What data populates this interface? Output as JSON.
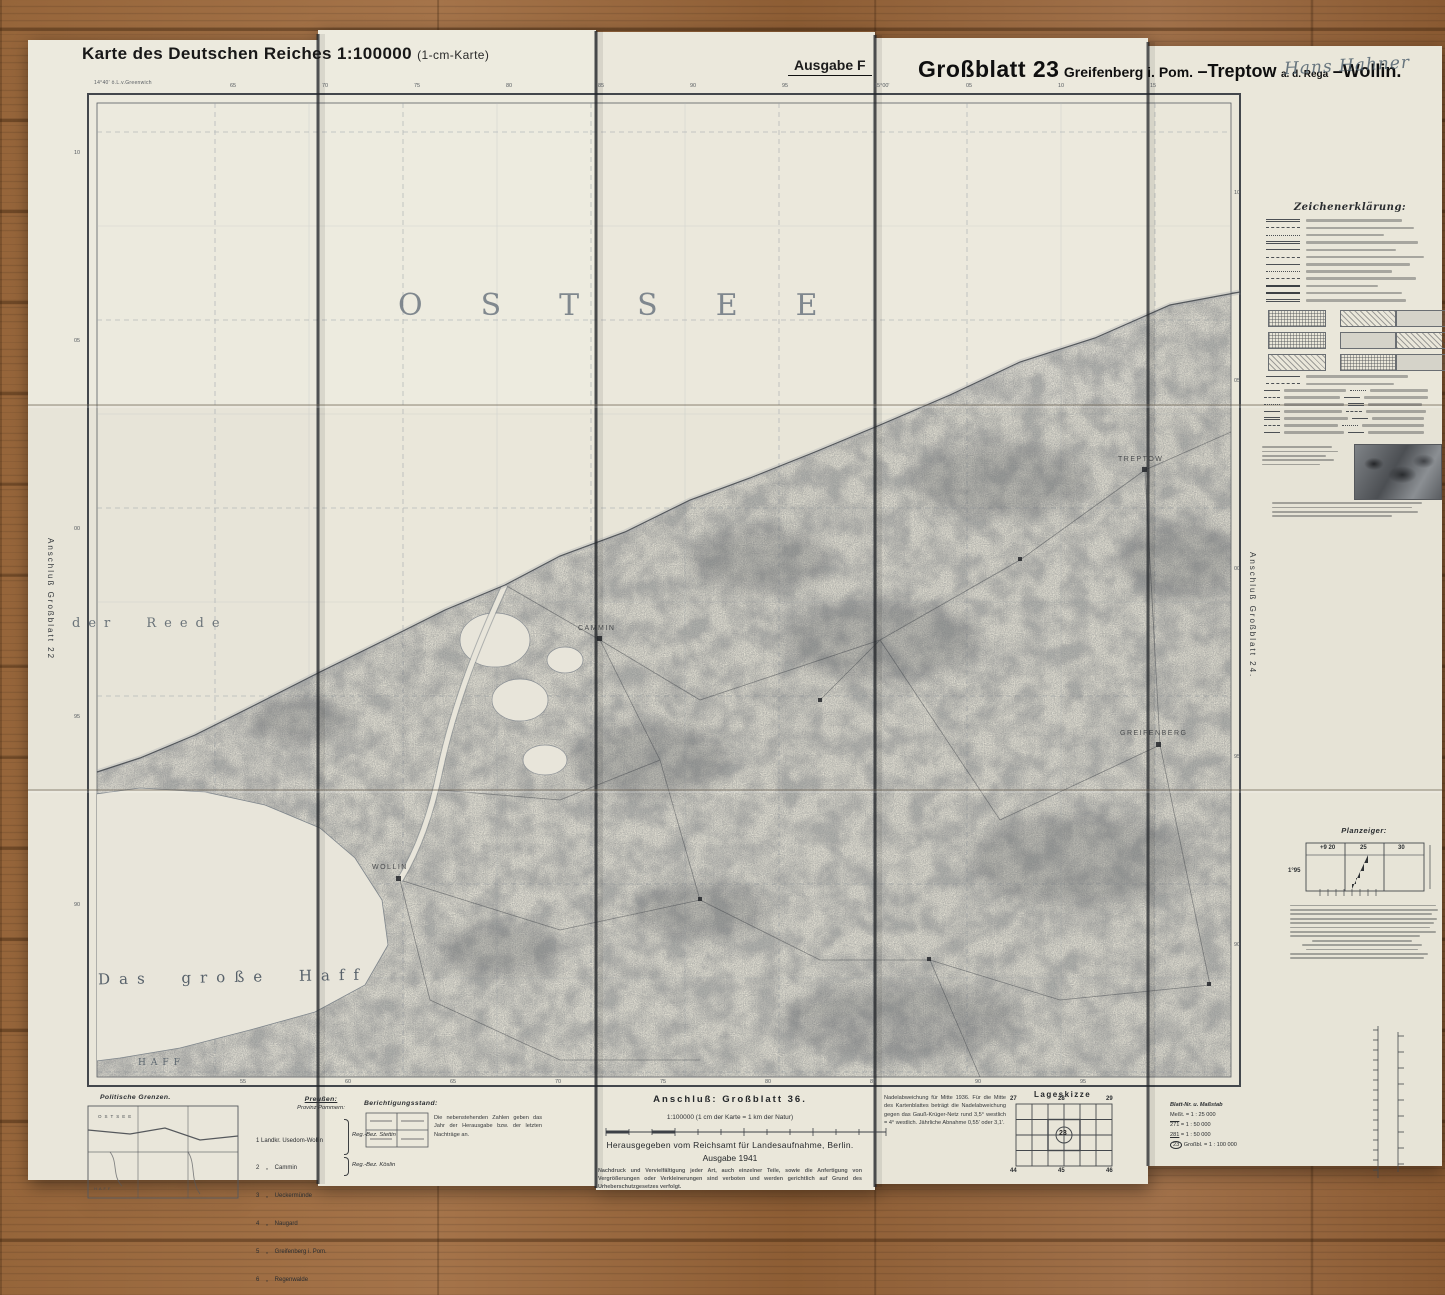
{
  "header": {
    "series_title": "Karte des Deutschen Reiches 1:100000",
    "series_subtitle": "(1-cm-Karte)",
    "edition": "Ausgabe F",
    "sheet_no": "Großblatt 23",
    "sheet_name_1": "Greifenberg i. Pom.",
    "sheet_sep_1": "–Treptow",
    "sheet_small_1": "a. d. Rega",
    "sheet_sep_2": "–Wollin.",
    "handwriting": "Hans Hahner"
  },
  "map_labels": {
    "sea": "OSTSEE",
    "reede": "der Reede",
    "haff_large": "Das große Haff",
    "haff_small": "HAFF",
    "towns": [
      {
        "name": "Treptow"
      },
      {
        "name": "Cammin"
      },
      {
        "name": "Wollin"
      },
      {
        "name": "Greifenberg"
      }
    ]
  },
  "margins": {
    "left_vertical": "Anschluß Großblatt 22",
    "right_vertical": "Anschluß Großblatt 24.",
    "bottom_anschluss": "Anschluß: Großblatt 36.",
    "top_left_note": "14°40' ö.L.v.Greenwich"
  },
  "ticks": {
    "top": [
      "65",
      "70",
      "75",
      "80",
      "85",
      "90",
      "95",
      "15°00'",
      "05",
      "10",
      "15"
    ],
    "bottom": [
      "55",
      "60",
      "65",
      "70",
      "75",
      "80",
      "85",
      "90",
      "95"
    ],
    "left": [
      "10",
      "05",
      "00",
      "95",
      "90"
    ],
    "right": [
      "10",
      "05",
      "00",
      "95",
      "90"
    ]
  },
  "legend": {
    "title": "Zeichenerklärung:"
  },
  "planzeiger": {
    "title": "Planzeiger:",
    "tick_a": "+9 20",
    "tick_b": "25",
    "tick_c": "30",
    "tick_d": "1°95"
  },
  "footer": {
    "scale_note": "1:100000 (1 cm der Karte = 1 km der Natur)",
    "publisher": "Herausgegeben vom Reichsamt für Landesaufnahme, Berlin.",
    "edition_year": "Ausgabe 1941",
    "copyright": "Nachdruck und Vervielfältigung jeder Art, auch einzelner Teile, sowie die Anfertigung von Vergrößerungen oder Verkleinerungen sind verboten und werden gerichtlich auf Grund des Urheberschutzgesetzes verfolgt.",
    "berichtigung": {
      "title": "Berichtigungsstand:",
      "note": "Die nebenstehenden Zahlen geben das Jahr der Herausgabe bzw. der letzten Nachträge an."
    },
    "nadel_text": "Nadelabweichung für Mitte 1936. Für die Mitte des Kartenblattes beträgt die Nadelabweichung gegen das Gauß-Krüger-Netz rund 3,5° westlich = 4° westlich. Jährliche Abnahme 0,55' oder 3,1'.",
    "lageskizze": {
      "title": "Lageskizze",
      "top": [
        "27",
        "28",
        "29"
      ],
      "bottom": [
        "44",
        "45",
        "46"
      ],
      "center": "23"
    },
    "blatt_table": {
      "title": "Blatt-Nr. u. Maßstab",
      "rows": [
        {
          "no": "Meßt.",
          "eq": "= 1 : 25 000"
        },
        {
          "no": "271",
          "eq": "= 1 : 50 000"
        },
        {
          "no": "281",
          "eq": "= 1 : 50 000"
        },
        {
          "no": "23",
          "eq": "Großbl. = 1 : 100 000"
        }
      ]
    },
    "politics": {
      "title": "Politische Grenzen.",
      "mini_sea": "OSTSEE",
      "mini_haff": "HAFF",
      "preussen": "Preußen:",
      "provinz": "Provinz Pommern:",
      "districts": [
        "1 Landkr. Usedom-Wollin",
        "2    „    Cammin",
        "3    „    Ueckermünde",
        "4    „    Naugard",
        "5    „    Greifenberg i. Pom.",
        "6    „    Regenwalde"
      ],
      "reg_bez_1": "Reg.-Bez. Stettin",
      "reg_bez_2": "Reg.-Bez. Köslin"
    }
  }
}
